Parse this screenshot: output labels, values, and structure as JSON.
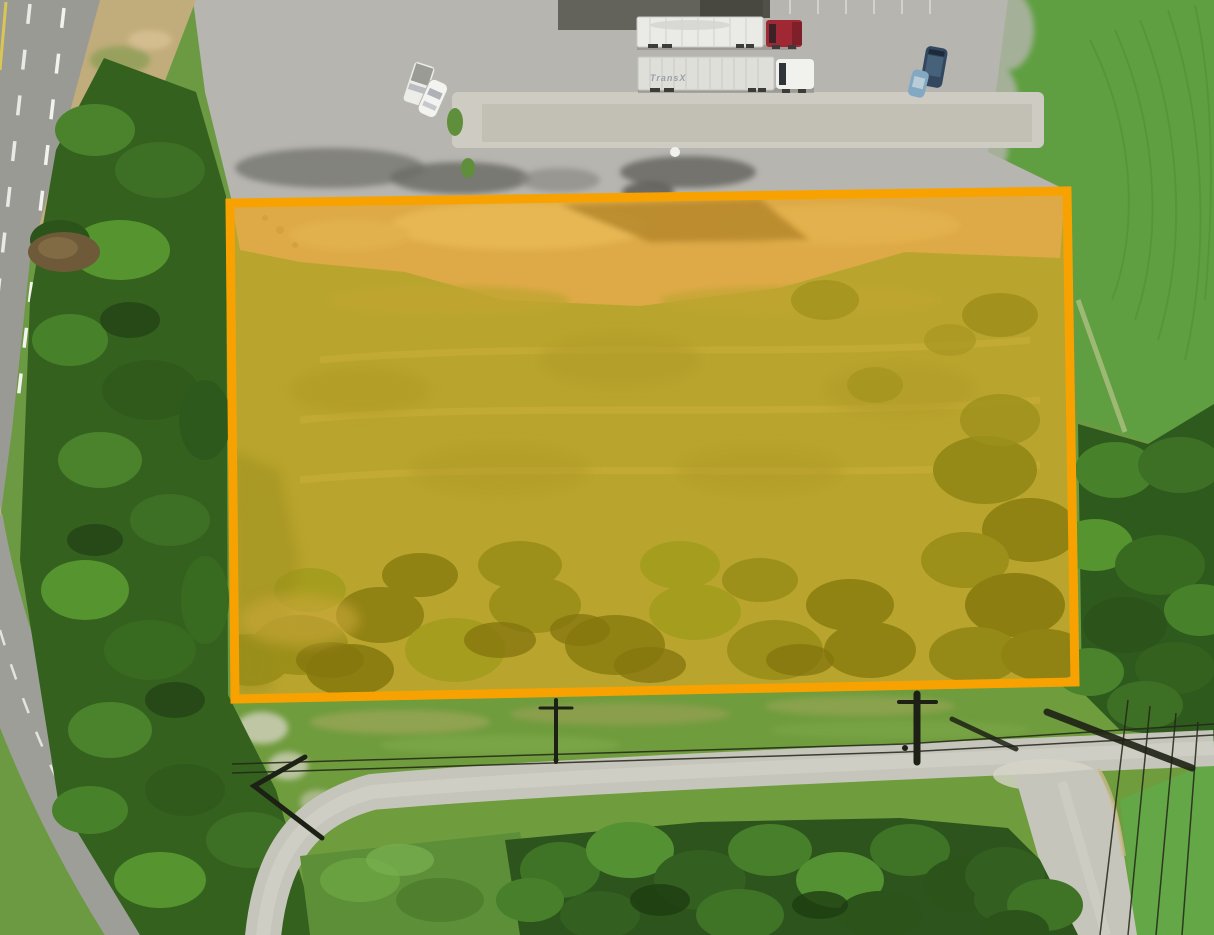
{
  "parcel": {
    "points": "230,203 1067,191 1075,682 235,699",
    "boundary_color": "#F8A202",
    "fill_color": "#FFAE00",
    "fill_opacity": "0.38"
  },
  "vehicles": {
    "semi_red": {
      "trailer": "#EAEAE6",
      "cab": "#A02834"
    },
    "semi_transx": {
      "trailer": "#DFDFDA",
      "cab": "#F1F1EE",
      "logo": "TransX"
    },
    "pickup": {
      "body": "#EDEDE8",
      "bed": "#9B9B96"
    },
    "sedan": {
      "body": "#F3F3EF"
    },
    "suv": {
      "body": "#33485F"
    },
    "compact": {
      "body": "#83A9C2"
    }
  }
}
